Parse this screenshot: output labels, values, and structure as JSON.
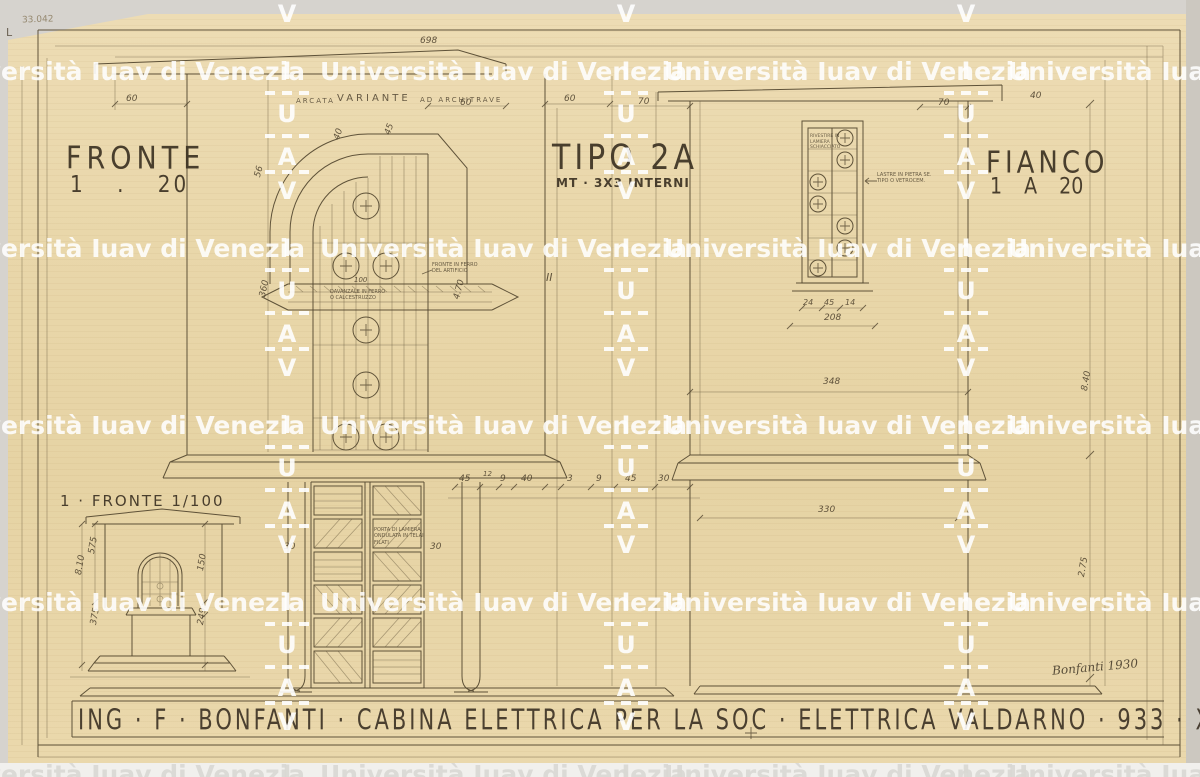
{
  "labels": {
    "fronte_title": "FRONTE",
    "fronte_scale": "1 . 20",
    "tipo_title": "TIPO 2A",
    "tipo_sub": "MT · 3X3 INTERNI",
    "fianco_title": "FIANCO",
    "fianco_scale": "1 A 20",
    "small_title": "1 · FRONTE 1/100"
  },
  "title_block": {
    "text": "ING · F · BONFANTI ·  CABINA ELETTRICA  PER  LA SOC · ELETTRICA  VALDARNO · 933 · XI"
  },
  "signature": "Bonfanti 1930",
  "archive_number": "33.042",
  "corner_mark": "L",
  "colors": {
    "paper": "#e9d7aa",
    "ink": "#52462f",
    "watermark_white": "#ffffff",
    "watermark_on_white": "#d9d8d3"
  },
  "watermark": {
    "text": "Università Iuav di Venezia",
    "letters": [
      "I",
      "U",
      "A",
      "V"
    ],
    "text_xs": [
      -62,
      320,
      664,
      1008
    ],
    "col_xs": [
      267,
      606,
      946
    ],
    "row_ys": [
      57,
      234,
      411,
      588,
      760
    ],
    "col_row_ys": [
      -120,
      57,
      234,
      411,
      588,
      760
    ],
    "letter_offsets": [
      0,
      43,
      86,
      120
    ],
    "dash_offsets": [
      34,
      77,
      113
    ]
  },
  "annotations": [
    {
      "t": "ARCATA",
      "x": 296,
      "y": 97,
      "s": 7,
      "ls": 2
    },
    {
      "t": "VARIANTE",
      "x": 337,
      "y": 93,
      "s": 10,
      "ls": 3
    },
    {
      "t": "AD ARCHITRAVE",
      "x": 420,
      "y": 96,
      "s": 7,
      "ls": 2
    },
    {
      "t": "DAVANZALE IN FERRO\nO CALCESTRUZZO",
      "x": 330,
      "y": 289,
      "s": 5
    },
    {
      "t": "FRONTE IN FERRO\nDEL ARTIFICIO",
      "x": 432,
      "y": 262,
      "s": 5
    },
    {
      "t": "RIVESTIRE IN\nLAMIERA\nSCHIACCIATO",
      "x": 810,
      "y": 134,
      "s": 4.5
    },
    {
      "t": "LASTRE IN PIETRA SE.\nTIPO O VETROCEM.",
      "x": 877,
      "y": 172,
      "s": 5
    },
    {
      "t": "PORTA DI LAMIERA\nONDULATA IN TELAI\nFILATI",
      "x": 374,
      "y": 527,
      "s": 5
    }
  ],
  "dimensions": [
    {
      "t": "698",
      "x": 420,
      "y": 36
    },
    {
      "t": "60",
      "x": 126,
      "y": 94
    },
    {
      "t": "60",
      "x": 460,
      "y": 98
    },
    {
      "t": "60",
      "x": 564,
      "y": 94
    },
    {
      "t": "70",
      "x": 638,
      "y": 97
    },
    {
      "t": "70",
      "x": 938,
      "y": 98
    },
    {
      "t": "40",
      "x": 1030,
      "y": 91
    },
    {
      "t": "56",
      "x": 253,
      "y": 176,
      "r": -75
    },
    {
      "t": "360",
      "x": 258,
      "y": 296,
      "r": -78
    },
    {
      "t": "40",
      "x": 332,
      "y": 138,
      "r": -70
    },
    {
      "t": "45",
      "x": 383,
      "y": 133,
      "r": -70
    },
    {
      "t": "100",
      "x": 354,
      "y": 276,
      "s": 7
    },
    {
      "t": "4.70",
      "x": 452,
      "y": 298,
      "r": -75
    },
    {
      "t": "45",
      "x": 459,
      "y": 474
    },
    {
      "t": "12",
      "x": 483,
      "y": 470,
      "s": 7
    },
    {
      "t": "9",
      "x": 500,
      "y": 474
    },
    {
      "t": "40",
      "x": 521,
      "y": 474
    },
    {
      "t": "3",
      "x": 567,
      "y": 474
    },
    {
      "t": "9",
      "x": 596,
      "y": 474
    },
    {
      "t": "45",
      "x": 625,
      "y": 474
    },
    {
      "t": "30",
      "x": 658,
      "y": 474
    },
    {
      "t": "30",
      "x": 284,
      "y": 542
    },
    {
      "t": "30",
      "x": 430,
      "y": 542
    },
    {
      "t": "24",
      "x": 803,
      "y": 298,
      "s": 8
    },
    {
      "t": "45",
      "x": 824,
      "y": 298,
      "s": 8
    },
    {
      "t": "14",
      "x": 845,
      "y": 298,
      "s": 8
    },
    {
      "t": "208",
      "x": 824,
      "y": 313
    },
    {
      "t": "348",
      "x": 823,
      "y": 377
    },
    {
      "t": "330",
      "x": 818,
      "y": 505
    },
    {
      "t": "8.40",
      "x": 1080,
      "y": 390,
      "r": -80
    },
    {
      "t": "2.75",
      "x": 1077,
      "y": 576,
      "r": -80
    },
    {
      "t": "575",
      "x": 87,
      "y": 553,
      "r": -80
    },
    {
      "t": "8.10",
      "x": 74,
      "y": 574,
      "r": -80
    },
    {
      "t": "150",
      "x": 196,
      "y": 570,
      "r": -80
    },
    {
      "t": "375",
      "x": 89,
      "y": 624,
      "r": -80
    },
    {
      "t": "249",
      "x": 196,
      "y": 624,
      "r": -80
    },
    {
      "t": "II",
      "x": 546,
      "y": 271,
      "s": 11
    }
  ]
}
